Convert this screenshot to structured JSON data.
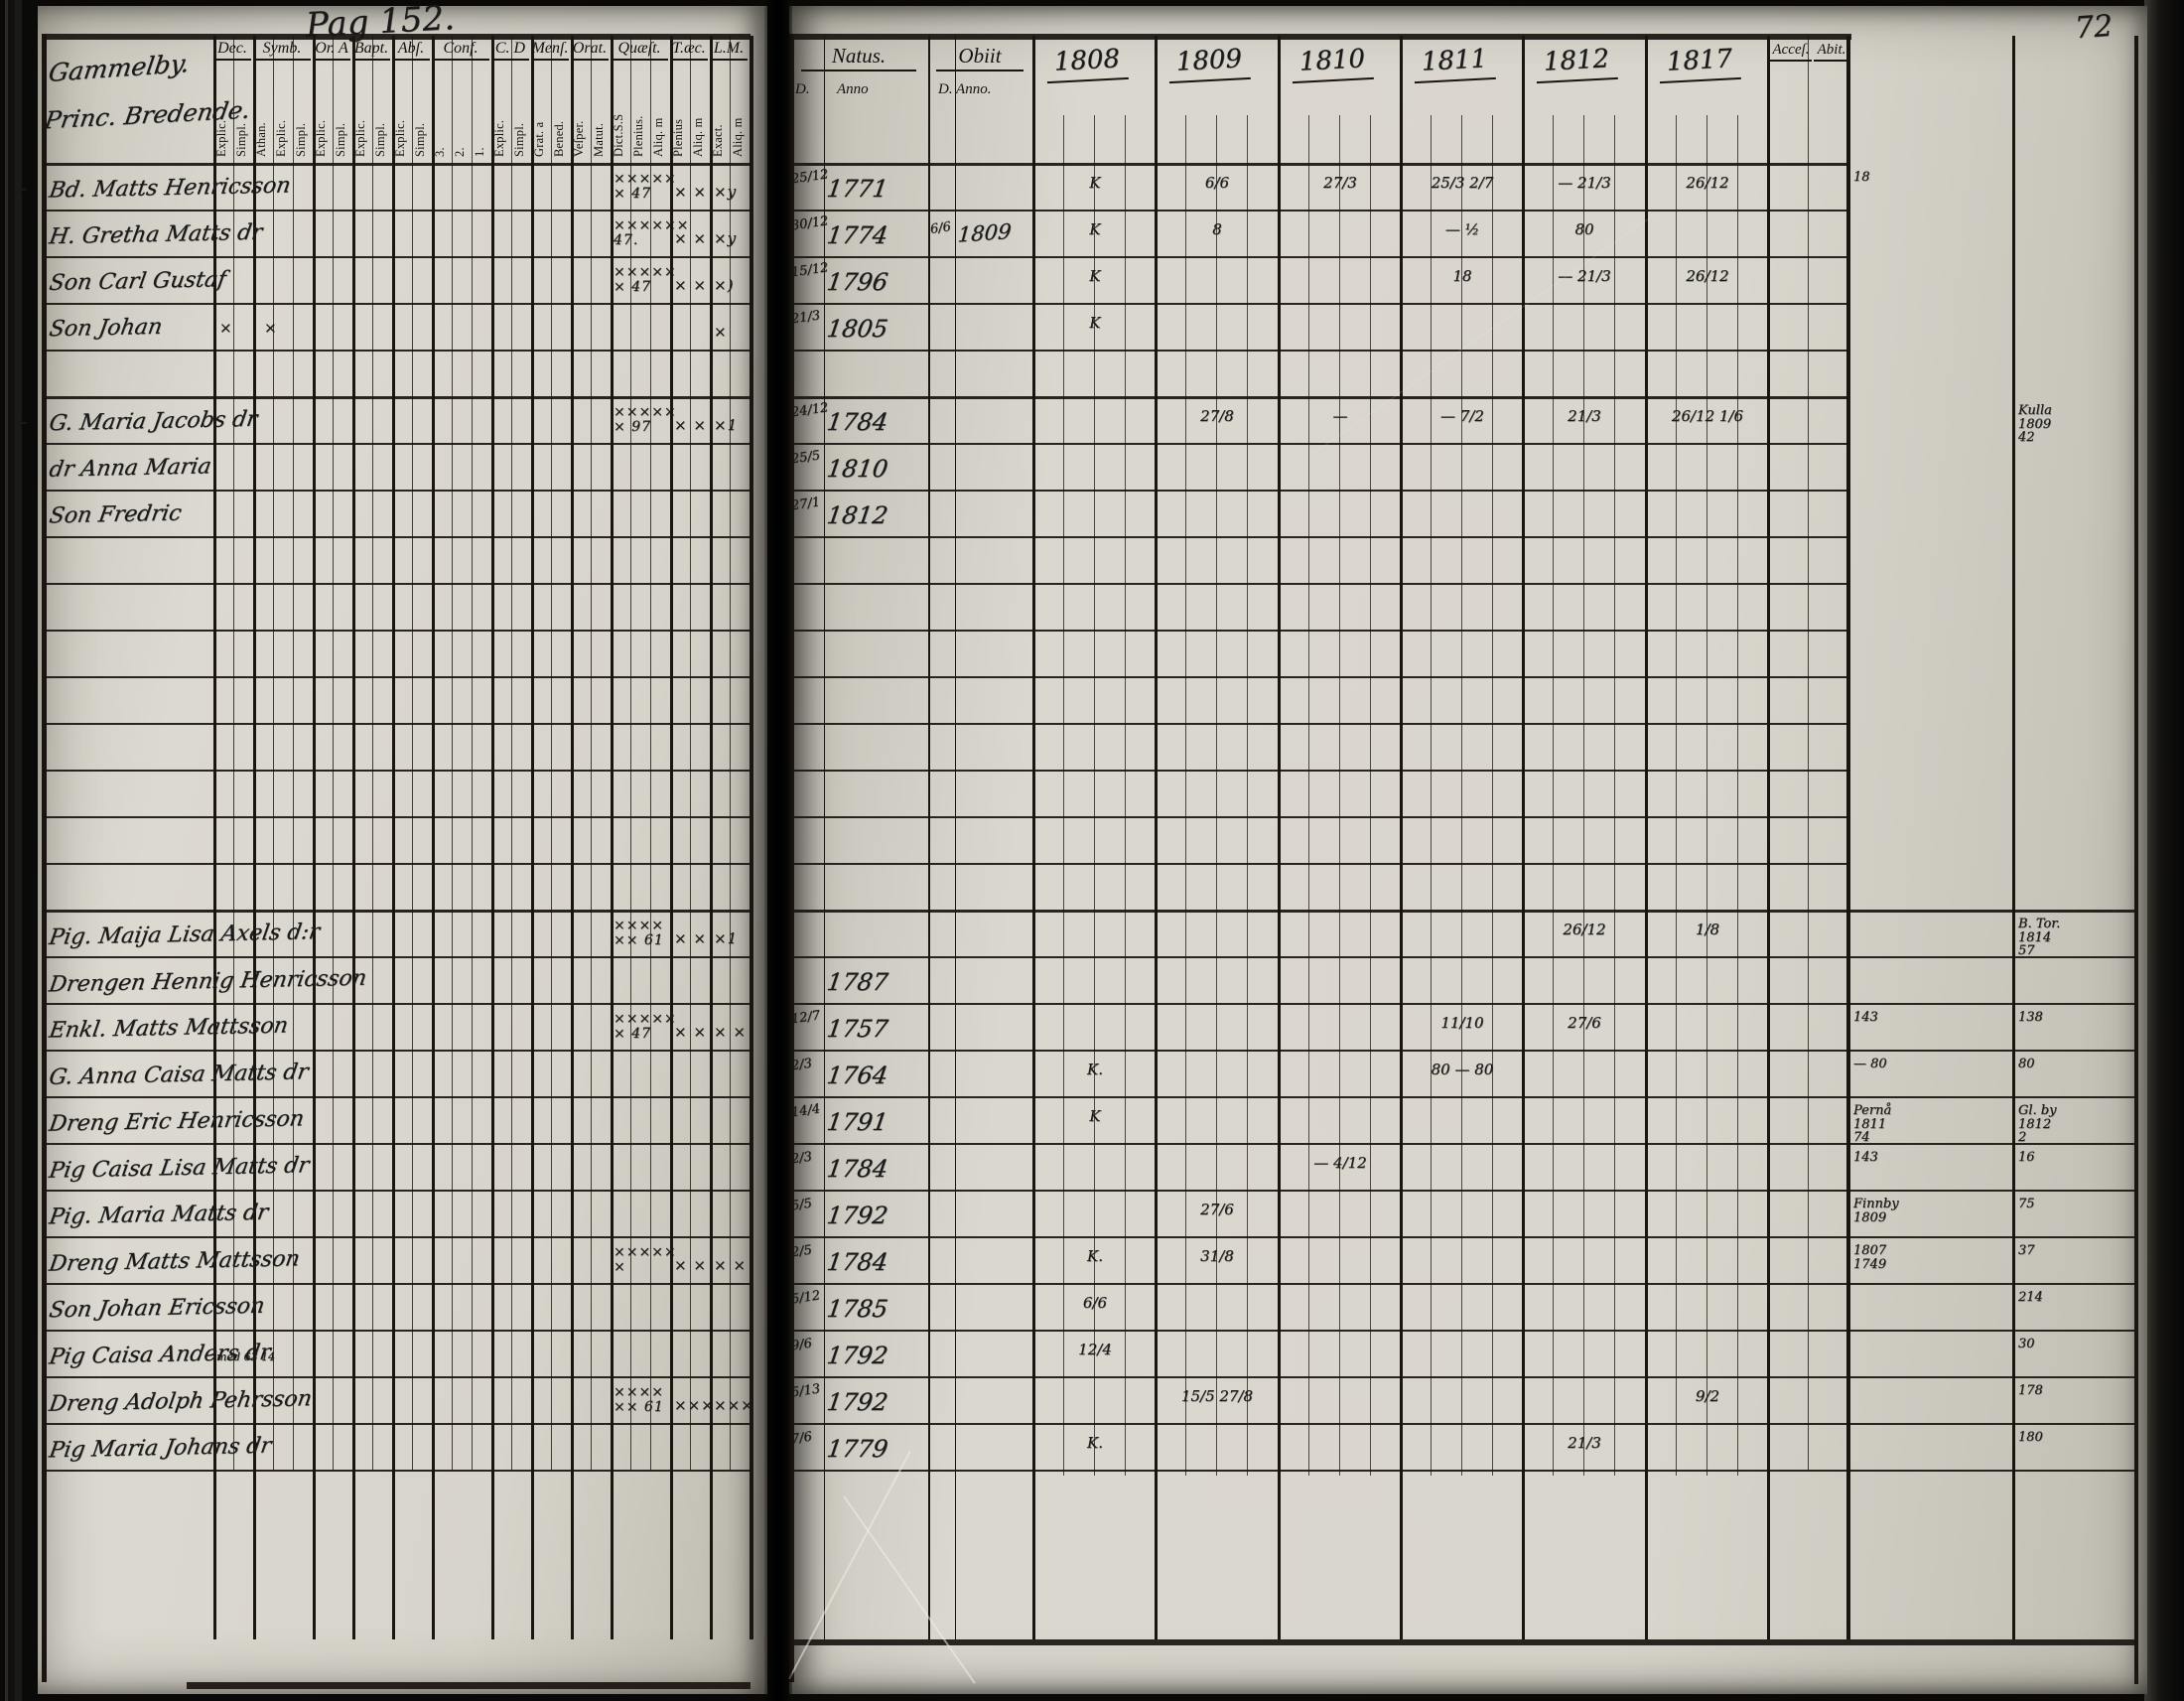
{
  "book": {
    "page_label": "Pag 152.",
    "corner_number": "72"
  },
  "left_page": {
    "village_line1": "Gammelby.",
    "village_line2": "Princ. Bredende.",
    "columns": [
      {
        "label": "Dec.",
        "subs": [
          "Explic.",
          "Simpl."
        ]
      },
      {
        "label": "Symb.",
        "subs": [
          "Athan.",
          "Explic.",
          "Simpl."
        ]
      },
      {
        "label": "Or. A",
        "subs": [
          "Explic.",
          "Simpl."
        ]
      },
      {
        "label": "Bapt.",
        "subs": [
          "Explic.",
          "Simpl."
        ]
      },
      {
        "label": "Abſ.",
        "subs": [
          "Explic.",
          "Simpl."
        ]
      },
      {
        "label": "Conf.",
        "subs": [
          "3.",
          "2.",
          "1."
        ]
      },
      {
        "label": "C. D",
        "subs": [
          "Explic.",
          "Simpl."
        ]
      },
      {
        "label": "Menſ.",
        "subs": [
          "Grat. a",
          "Bened."
        ]
      },
      {
        "label": "Orat.",
        "subs": [
          "Veſper.",
          "Matut."
        ]
      },
      {
        "label": "Quæſt.",
        "subs": [
          "Dict.S.S",
          "Plenius.",
          "Aliq. m"
        ]
      },
      {
        "label": "T.æc.",
        "subs": [
          "Plenius",
          "Aliq. m"
        ]
      },
      {
        "label": "L.M.",
        "subs": [
          "Exact.",
          "Aliq. m"
        ]
      }
    ]
  },
  "right_page": {
    "natus_label": "Natus.",
    "natus_sub_d": "D.",
    "natus_sub_anno": "Anno",
    "obiit_label": "Obiit",
    "obiit_sub": "D. Anno.",
    "years": [
      "1808",
      "1809",
      "1810",
      "1811",
      "1812",
      "1817"
    ],
    "acces_label": "Acceſ.",
    "abit_label": "Abit."
  },
  "rows": [
    {
      "g": 1,
      "margin": "+",
      "name": "Bd. Matts Henricsson",
      "q": "×××××\n× 47",
      "t": "× ×",
      "l": "×y",
      "nd": "25/12",
      "na": "1771",
      "y08": "K",
      "y09": "6/6",
      "y10": "27/3",
      "y11": "25/3  2/7",
      "y12": "—  21/3",
      "y17": "26/12",
      "acc": "18"
    },
    {
      "name": "H. Gretha Matts dr",
      "q": "××××××\n47.",
      "t": "× ×",
      "l": "×y",
      "nd": "30/12",
      "na": "1774",
      "od": "6/6",
      "oa": "1809",
      "y08": "K",
      "y09": "8",
      "y11": "—  ½",
      "y12": "80"
    },
    {
      "name": "Son Carl Gustaf",
      "q": "×××××\n× 47",
      "t": "× ×",
      "l": "×)",
      "nd": "15/12",
      "na": "1796",
      "y08": "K",
      "y11": "18",
      "y12": "—  21/3",
      "y17": "26/12"
    },
    {
      "name": "Son Johan",
      "dec": "×",
      "symb": "×",
      "l": "×",
      "nd": "21/3",
      "na": "1805",
      "y08": "K"
    },
    {},
    {
      "g": 1,
      "margin": "+",
      "name": "G. Maria Jacobs dr",
      "q": "×××××\n× 97",
      "t": "× ×",
      "l": "×1",
      "nd": "24/12",
      "na": "1784",
      "y09": "27/8",
      "y10": "—",
      "y11": "—  7/2",
      "y12": "21/3",
      "y17": "26/12  1/6",
      "abt": "Kulla\n1809\n42"
    },
    {
      "name": "dr Anna Maria",
      "nd": "25/5",
      "na": "1810"
    },
    {
      "name": "Son Fredric",
      "nd": "27/1",
      "na": "1812"
    },
    {},
    {},
    {},
    {},
    {},
    {},
    {},
    {},
    {
      "g": 1,
      "name": "Pig. Maija Lisa Axels d:r",
      "q": "××××\n×× 61",
      "t": "× ×",
      "l": "×1",
      "y12": "26/12",
      "y17": "1/8",
      "abt": "B. Tor.\n1814\n57"
    },
    {
      "name": "Drengen Hennig Henricsson",
      "na": "1787"
    },
    {
      "name": "Enkl. Matts Mattsson",
      "q": "×××××\n× 47",
      "t": "× ×",
      "l": "× ×",
      "nd": "12/7",
      "na": "1757",
      "y11": "11/10",
      "y12": "27/6",
      "acc": "143",
      "abt": "138"
    },
    {
      "name": "G. Anna Caisa Matts dr",
      "nd": "2/3",
      "na": "1764",
      "y08": "K.",
      "y11": "80 — 80",
      "acc": "— 80",
      "abt": "80"
    },
    {
      "name": "Dreng Eric Henricsson",
      "nd": "14/4",
      "na": "1791",
      "y08": "K",
      "acc": "Pernå\n1811\n74",
      "abt": "Gl. by\n1812\n2"
    },
    {
      "name": "Pig Caisa Lisa Matts dr",
      "nd": "2/3",
      "na": "1784",
      "y10": "—  4/12",
      "acc": "143",
      "abt": "16"
    },
    {
      "name": "Pig. Maria Matts dr",
      "nd": "5/5",
      "na": "1792",
      "y09": "27/6",
      "acc": "Finnby\n1809",
      "abt": "75"
    },
    {
      "name": "Dreng Matts Mattsson",
      "q": "×××××\n×",
      "t": "× ×",
      "l": "× ×",
      "nd": "2/5",
      "na": "1784",
      "y08": "K.",
      "y09": "31/8",
      "acc": "1807\n1749",
      "abt": "37"
    },
    {
      "name": "Son Johan Ericsson",
      "nd": "5/12",
      "na": "1785",
      "y08": "6/6",
      "abt": "214"
    },
    {
      "name": "Pig Caisa Anders dr",
      "note": "med 63   14",
      "nd": "9/6",
      "na": "1792",
      "y08": "12/4",
      "abt": "30"
    },
    {
      "name": "Dreng Adolph Pehrsson",
      "q": "××××\n×× 61",
      "t": "×××",
      "l": "×××",
      "nd": "5/13",
      "na": "1792",
      "y09": "15/5  27/8",
      "y17": "9/2",
      "abt": "178"
    },
    {
      "name": "Pig Maria Johans dr",
      "nd": "7/6",
      "na": "1779",
      "y08": "K.",
      "y12": "21/3",
      "abt": "180"
    },
    {},
    {}
  ]
}
